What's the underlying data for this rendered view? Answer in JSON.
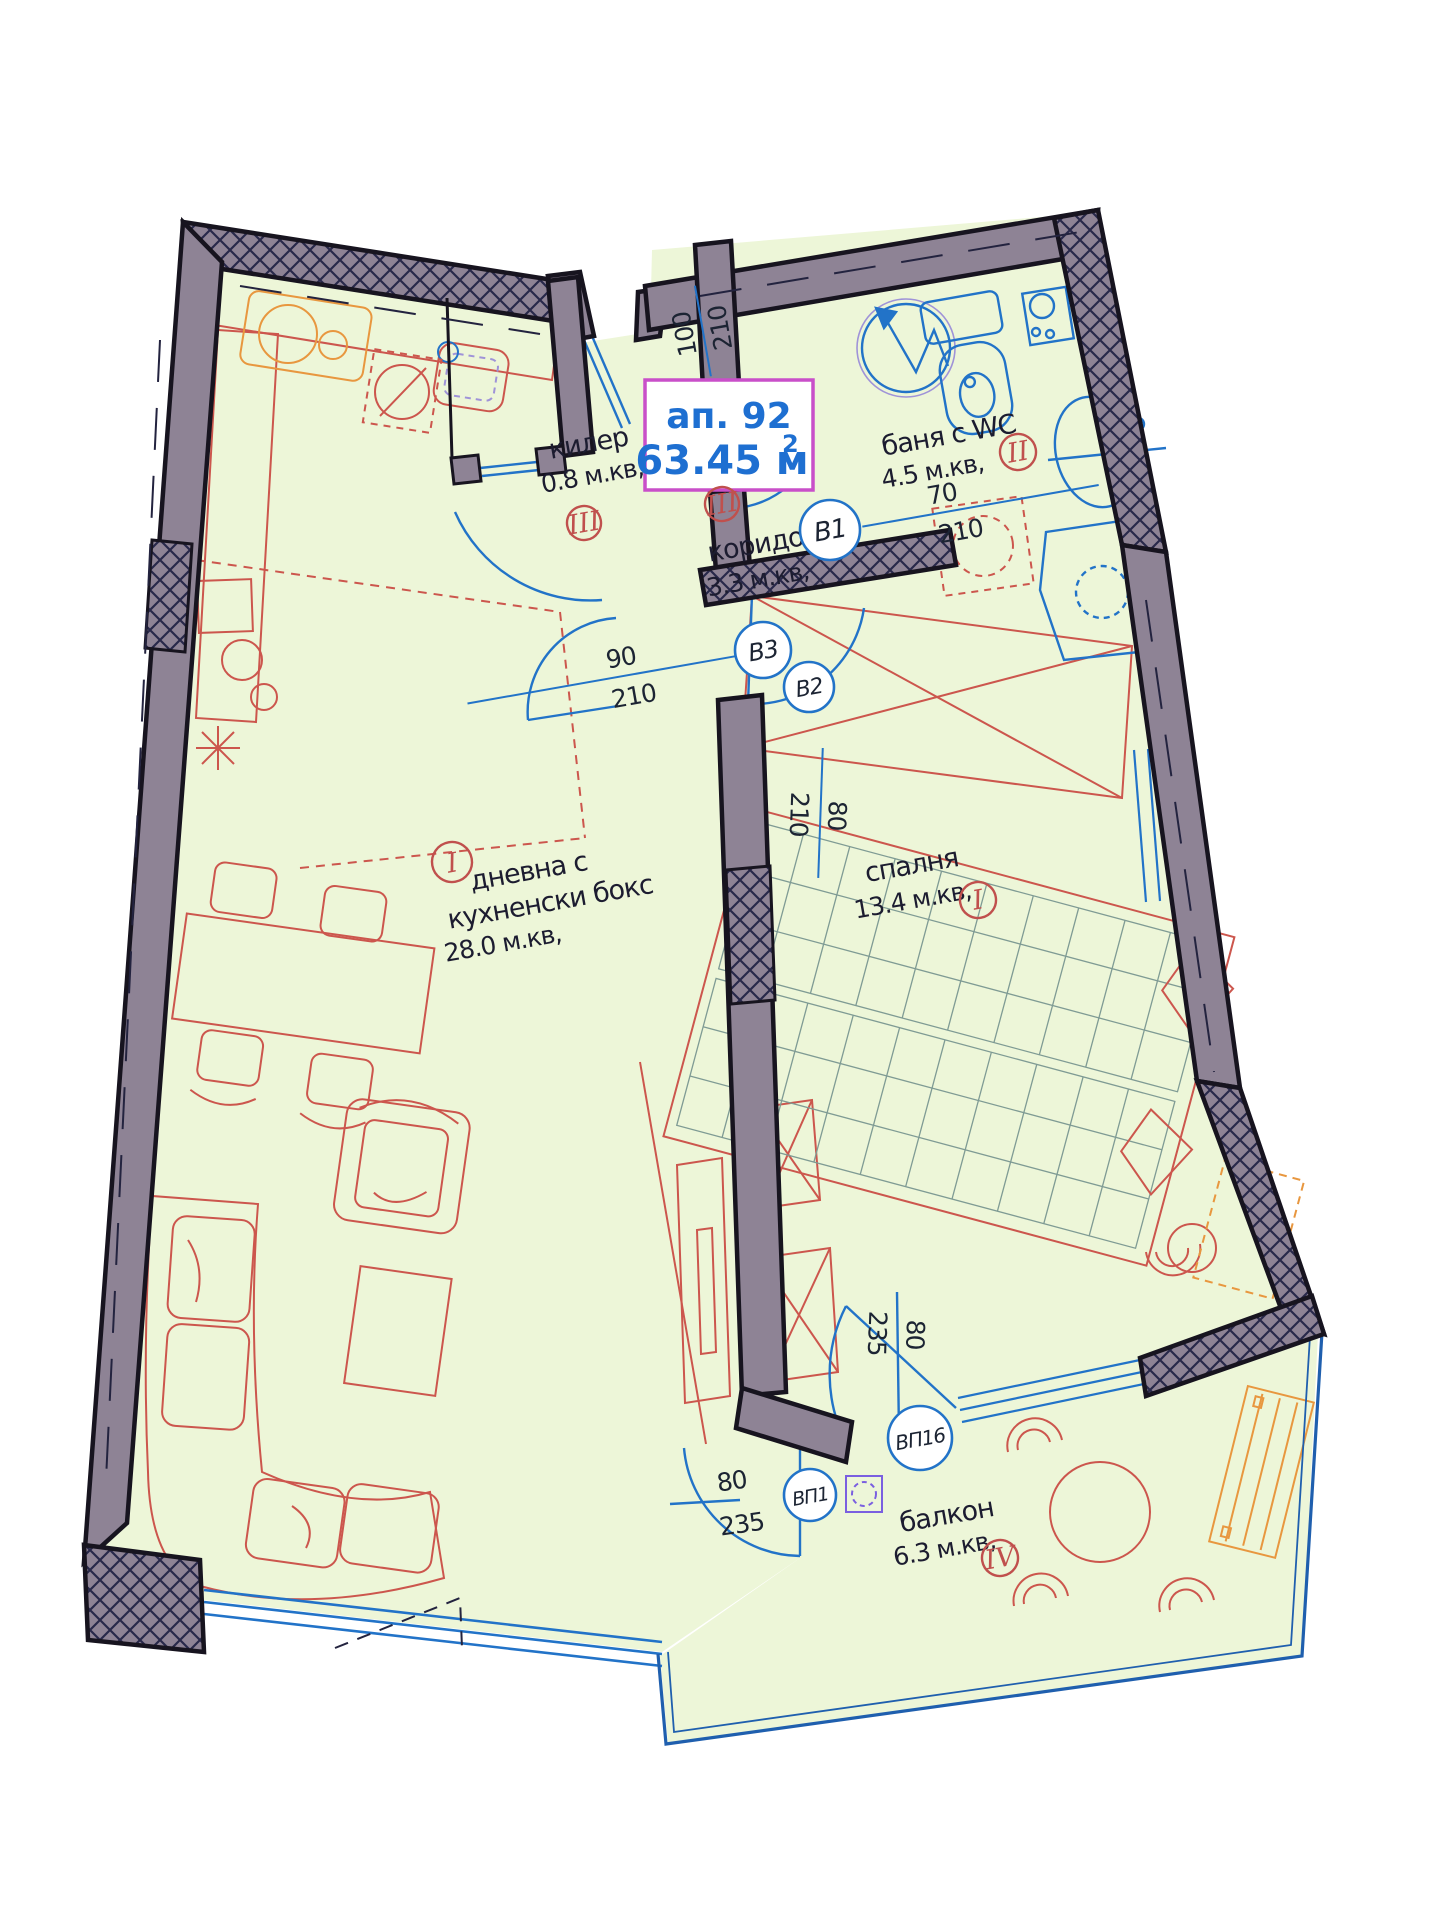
{
  "plan": {
    "title": {
      "apartment": "ап. 92",
      "area_value": "63.45 м",
      "area_sup": "2"
    },
    "rooms": {
      "pantry": {
        "name": "килер",
        "area": "0.8 м.кв,",
        "marker": "III"
      },
      "corridor": {
        "name": "коридор",
        "area": "3.3 м.кв,",
        "marker": "III"
      },
      "bathroom": {
        "name": "баня с WC",
        "area": "4.5 м.кв,",
        "marker": "II"
      },
      "living": {
        "name_line1": "дневна с",
        "name_line2": "кухненски бокс",
        "area": "28.0 м.кв,",
        "marker": "I"
      },
      "bedroom": {
        "name": "спалня",
        "area": "13.4 м.кв,",
        "marker": "I"
      },
      "balcony": {
        "name": "балкон",
        "area": "6.3 м.кв,",
        "marker": "IV"
      }
    },
    "doors": {
      "entry": {
        "width": "100",
        "height": "210"
      },
      "b1": {
        "label": "В1",
        "width": "70",
        "height": "210"
      },
      "b2": {
        "label": "В2",
        "width": "80",
        "height": "210"
      },
      "b3": {
        "label": "В3",
        "width": "90",
        "height": "210"
      },
      "bp1": {
        "label": "ВП1",
        "width": "80",
        "height": "235"
      },
      "bp16": {
        "label": "ВП16",
        "width": "80",
        "height": "235"
      }
    },
    "colors": {
      "floor": "#edf6d8",
      "wall": "#8e8395",
      "wall_edge": "#17141f",
      "fixture_blue": "#2273c8",
      "furniture_red": "#cc564d",
      "accent_orange": "#e8973f",
      "marker_red": "#c0504d",
      "title_blue": "#1e6fd1",
      "title_border": "#c94fc9"
    }
  }
}
